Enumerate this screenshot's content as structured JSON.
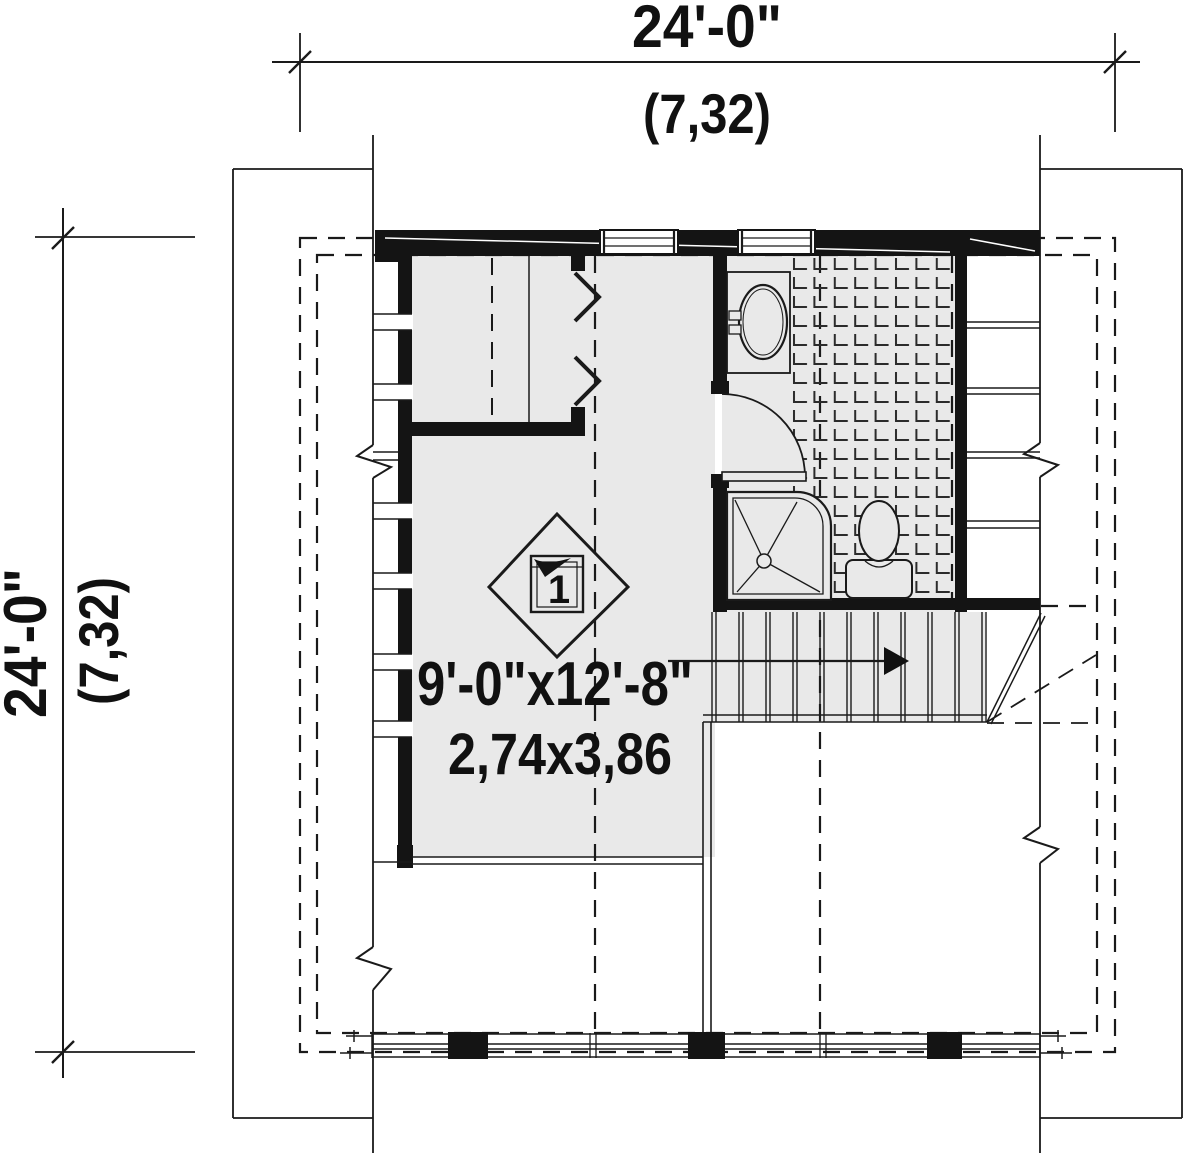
{
  "drawing": {
    "type_label": "floor-plan",
    "dimensions": {
      "top": {
        "imperial": "24'-0\"",
        "metric": "(7,32)"
      },
      "left": {
        "imperial": "24'-0\"",
        "metric": "(7,32)"
      }
    },
    "room": {
      "size_imperial": "9'-0\"x12'-8\"",
      "size_metric": "2,74x3,86"
    },
    "space_tag": {
      "number": "1"
    },
    "colors": {
      "ink": "#1a1a1a",
      "wall_fill": "#141414",
      "floor_fill": "#e9e9e9",
      "background": "#ffffff"
    }
  }
}
